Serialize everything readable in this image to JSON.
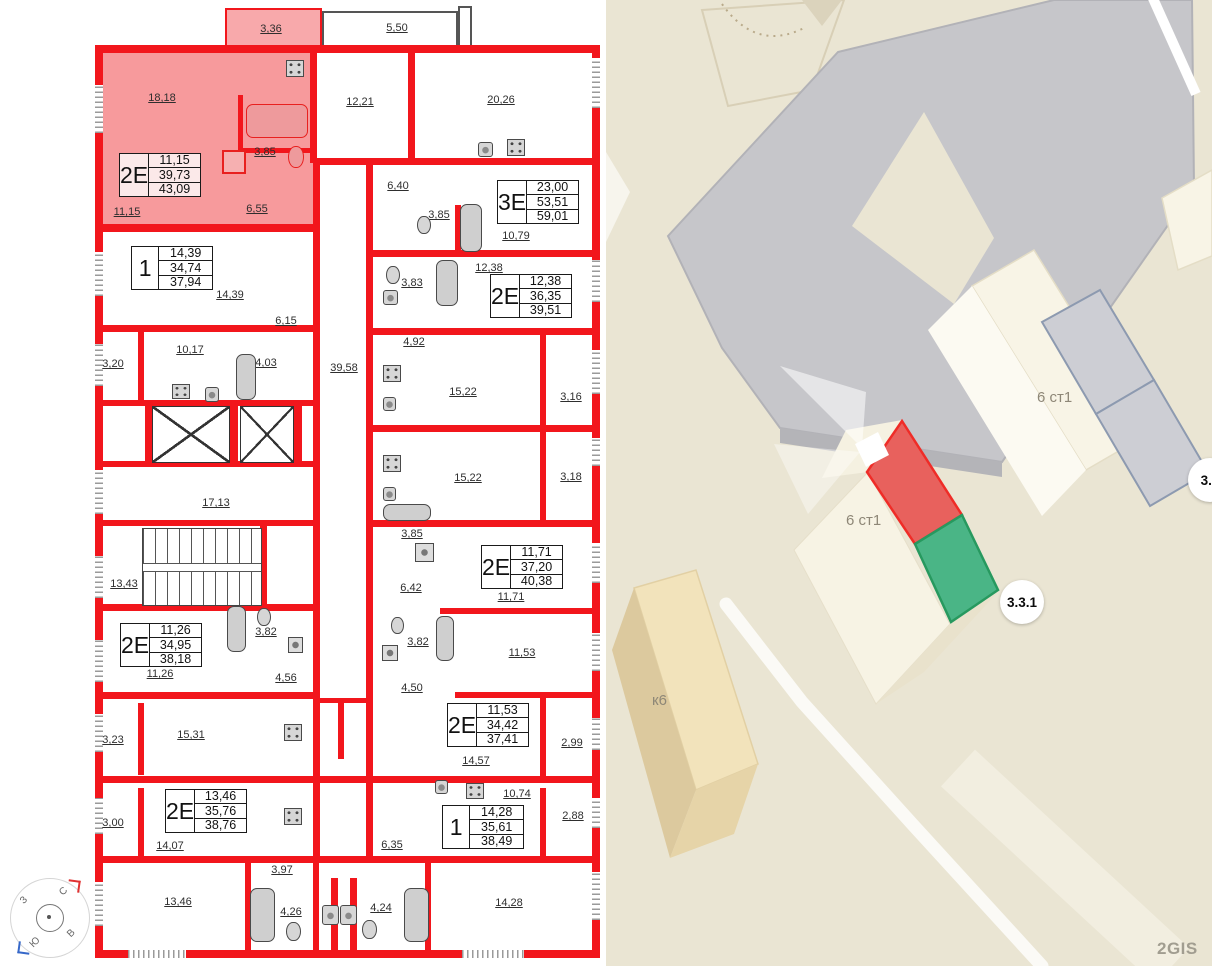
{
  "plan": {
    "units": [
      {
        "type": "2Е",
        "rows": [
          "11,15",
          "39,73",
          "43,09"
        ],
        "x": 119,
        "y": 153,
        "highlight": true
      },
      {
        "type": "1",
        "rows": [
          "14,39",
          "34,74",
          "37,94"
        ],
        "x": 131,
        "y": 246,
        "highlight": false
      },
      {
        "type": "3Е",
        "rows": [
          "23,00",
          "53,51",
          "59,01"
        ],
        "x": 497,
        "y": 180,
        "highlight": false
      },
      {
        "type": "2Е",
        "rows": [
          "12,38",
          "36,35",
          "39,51"
        ],
        "x": 490,
        "y": 274,
        "highlight": false
      },
      {
        "type": "2Е",
        "rows": [
          "11,71",
          "37,20",
          "40,38"
        ],
        "x": 481,
        "y": 545,
        "highlight": false
      },
      {
        "type": "2Е",
        "rows": [
          "11,26",
          "34,95",
          "38,18"
        ],
        "x": 120,
        "y": 623,
        "highlight": false
      },
      {
        "type": "2Е",
        "rows": [
          "11,53",
          "34,42",
          "37,41"
        ],
        "x": 447,
        "y": 703,
        "highlight": false
      },
      {
        "type": "2Е",
        "rows": [
          "13,46",
          "35,76",
          "38,76"
        ],
        "x": 165,
        "y": 789,
        "highlight": false
      },
      {
        "type": "1",
        "rows": [
          "14,28",
          "35,61",
          "38,49"
        ],
        "x": 442,
        "y": 805,
        "highlight": false
      }
    ],
    "room_labels": [
      {
        "t": "18,18",
        "x": 162,
        "y": 98
      },
      {
        "t": "3,36",
        "x": 271,
        "y": 29
      },
      {
        "t": "5,50",
        "x": 397,
        "y": 28
      },
      {
        "t": "12,21",
        "x": 360,
        "y": 102
      },
      {
        "t": "20,26",
        "x": 501,
        "y": 100
      },
      {
        "t": "3,85",
        "x": 265,
        "y": 152
      },
      {
        "t": "11,15",
        "x": 127,
        "y": 212
      },
      {
        "t": "6,55",
        "x": 257,
        "y": 209
      },
      {
        "t": "6,40",
        "x": 398,
        "y": 186
      },
      {
        "t": "3,85",
        "x": 439,
        "y": 215
      },
      {
        "t": "10,79",
        "x": 516,
        "y": 236
      },
      {
        "t": "14,39",
        "x": 230,
        "y": 295
      },
      {
        "t": "6,15",
        "x": 286,
        "y": 321
      },
      {
        "t": "3,83",
        "x": 412,
        "y": 283
      },
      {
        "t": "12,38",
        "x": 489,
        "y": 268
      },
      {
        "t": "3,20",
        "x": 113,
        "y": 364
      },
      {
        "t": "10,17",
        "x": 190,
        "y": 350
      },
      {
        "t": "4,03",
        "x": 266,
        "y": 363
      },
      {
        "t": "39,58",
        "x": 344,
        "y": 368
      },
      {
        "t": "4,92",
        "x": 414,
        "y": 342
      },
      {
        "t": "15,22",
        "x": 463,
        "y": 392
      },
      {
        "t": "3,16",
        "x": 571,
        "y": 397
      },
      {
        "t": "15,22",
        "x": 468,
        "y": 478
      },
      {
        "t": "3,18",
        "x": 571,
        "y": 477
      },
      {
        "t": "17,13",
        "x": 216,
        "y": 503
      },
      {
        "t": "13,43",
        "x": 124,
        "y": 584
      },
      {
        "t": "3,85",
        "x": 412,
        "y": 534
      },
      {
        "t": "6,42",
        "x": 411,
        "y": 588
      },
      {
        "t": "11,71",
        "x": 511,
        "y": 597
      },
      {
        "t": "11,26",
        "x": 160,
        "y": 674
      },
      {
        "t": "3,82",
        "x": 266,
        "y": 632
      },
      {
        "t": "4,56",
        "x": 286,
        "y": 678
      },
      {
        "t": "3,82",
        "x": 418,
        "y": 642
      },
      {
        "t": "4,50",
        "x": 412,
        "y": 688
      },
      {
        "t": "11,53",
        "x": 522,
        "y": 653
      },
      {
        "t": "14,57",
        "x": 476,
        "y": 761
      },
      {
        "t": "2,99",
        "x": 572,
        "y": 743
      },
      {
        "t": "15,31",
        "x": 191,
        "y": 735
      },
      {
        "t": "3,23",
        "x": 113,
        "y": 740
      },
      {
        "t": "3,00",
        "x": 113,
        "y": 823
      },
      {
        "t": "14,07",
        "x": 170,
        "y": 846
      },
      {
        "t": "10,74",
        "x": 517,
        "y": 794
      },
      {
        "t": "2,88",
        "x": 573,
        "y": 816
      },
      {
        "t": "6,35",
        "x": 392,
        "y": 845
      },
      {
        "t": "13,46",
        "x": 178,
        "y": 902
      },
      {
        "t": "3,97",
        "x": 282,
        "y": 870
      },
      {
        "t": "4,26",
        "x": 291,
        "y": 912
      },
      {
        "t": "4,24",
        "x": 381,
        "y": 908
      },
      {
        "t": "14,28",
        "x": 509,
        "y": 903
      }
    ]
  },
  "map": {
    "labels": [
      {
        "t": "6 ст1",
        "x": 846,
        "y": 512
      },
      {
        "t": "6 ст1",
        "x": 1037,
        "y": 389
      },
      {
        "t": "к6",
        "x": 652,
        "y": 692
      }
    ],
    "badges": [
      {
        "t": "3.3.1",
        "x": 1000,
        "y": 580
      },
      {
        "t": "3.3",
        "x": 1188,
        "y": 458
      }
    ],
    "watermark": "2GIS",
    "compass": {
      "n": "С",
      "e": "В",
      "s": "Ю",
      "w": "З"
    }
  },
  "colors": {
    "wall_red": "#f2161c",
    "highlight_pink": "#f79a9c",
    "map_bg": "#eae5d3",
    "section_red": "#e8615d",
    "section_green": "#4ab586",
    "gray_building": "#c6c6ca"
  }
}
